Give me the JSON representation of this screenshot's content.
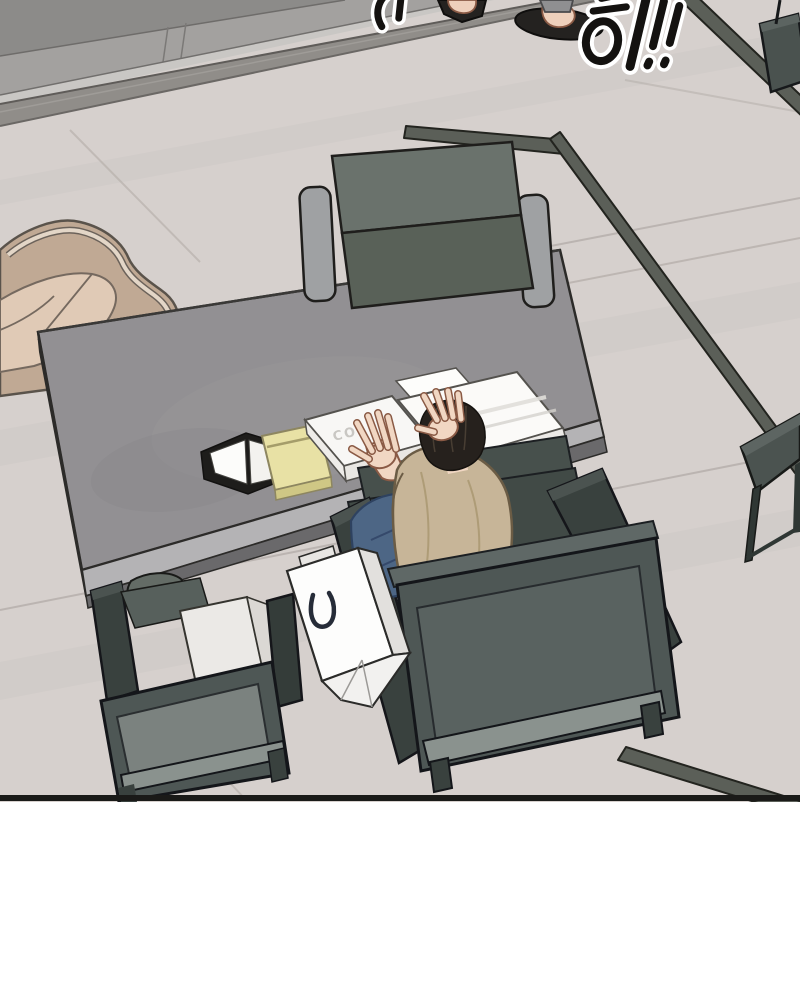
{
  "scene": {
    "sfx": {
      "right": "히!!",
      "left_partial": "하"
    },
    "desk_items": {
      "box_label": "CO"
    }
  },
  "colors": {
    "floor": "#d6d0cd",
    "grout": "#b2aba7",
    "cabinet": "#a3a19f",
    "metal_strip": "#908d89",
    "rug_strip": "#5b5f58",
    "desk": "#929093",
    "guest_chair": "#6a726c",
    "armrest_gray": "#9fa1a3",
    "armchair_shell": "#c0a994",
    "armchair_cushion": "#e0cab6",
    "hair": "#26211d",
    "skin": "#f1d7c3",
    "shirt": "#c7b598",
    "jeans": "#4d6685",
    "chair_frame": "#39413e",
    "chair_back": "#4e5755",
    "chair_inset": "#596260",
    "chair_rail": "#8a928e",
    "bag": "#fdfdfc",
    "notepad": "#e8e1a5",
    "box": "#fbfaf8",
    "folder": "#ebe9e6",
    "table": "#4b5350",
    "slipper": "#242220",
    "sfx_ink": "#141210",
    "panel_border": "#1a1a18"
  }
}
